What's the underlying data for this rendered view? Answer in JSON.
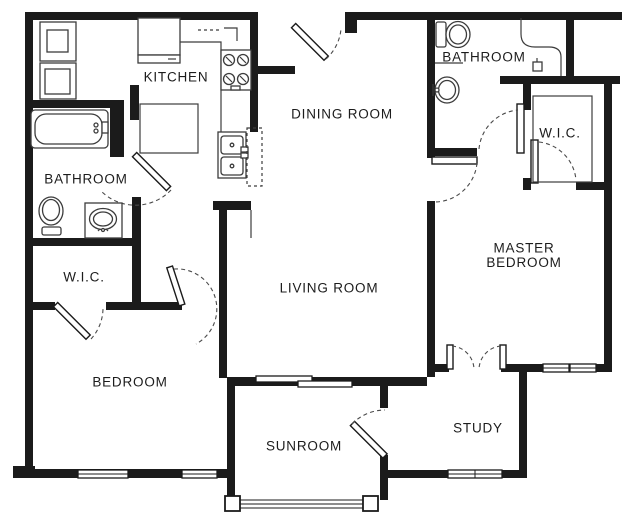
{
  "title": "Two bedroom apartment floor plan",
  "rooms": {
    "kitchen": {
      "label": "KITCHEN"
    },
    "dining_room": {
      "label": "DINING ROOM"
    },
    "bathroom_left": {
      "label": "BATHROOM"
    },
    "wic_left": {
      "label": "W.I.C."
    },
    "bedroom": {
      "label": "BEDROOM"
    },
    "living_room": {
      "label": "LIVING ROOM"
    },
    "sunroom": {
      "label": "SUNROOM"
    },
    "study": {
      "label": "STUDY"
    },
    "bathroom_master": {
      "label": "BATHROOM"
    },
    "wic_master": {
      "label": "W.I.C."
    },
    "master_bedroom": {
      "label_line1": "MASTER",
      "label_line2": "BEDROOM"
    }
  },
  "fixtures": [
    "stacked-washer-dryer",
    "refrigerator",
    "upper-cabinets",
    "range-stove",
    "double-kitchen-sink",
    "dishwasher",
    "pantry-closet",
    "bathtub",
    "toilet",
    "pedestal-sink",
    "shower",
    "closet-shelving",
    "sliding-glass-door",
    "french-doors",
    "entry-door"
  ],
  "colors": {
    "wall": "#1b1b1b",
    "line": "#3c3c3c",
    "background": "#ffffff"
  }
}
